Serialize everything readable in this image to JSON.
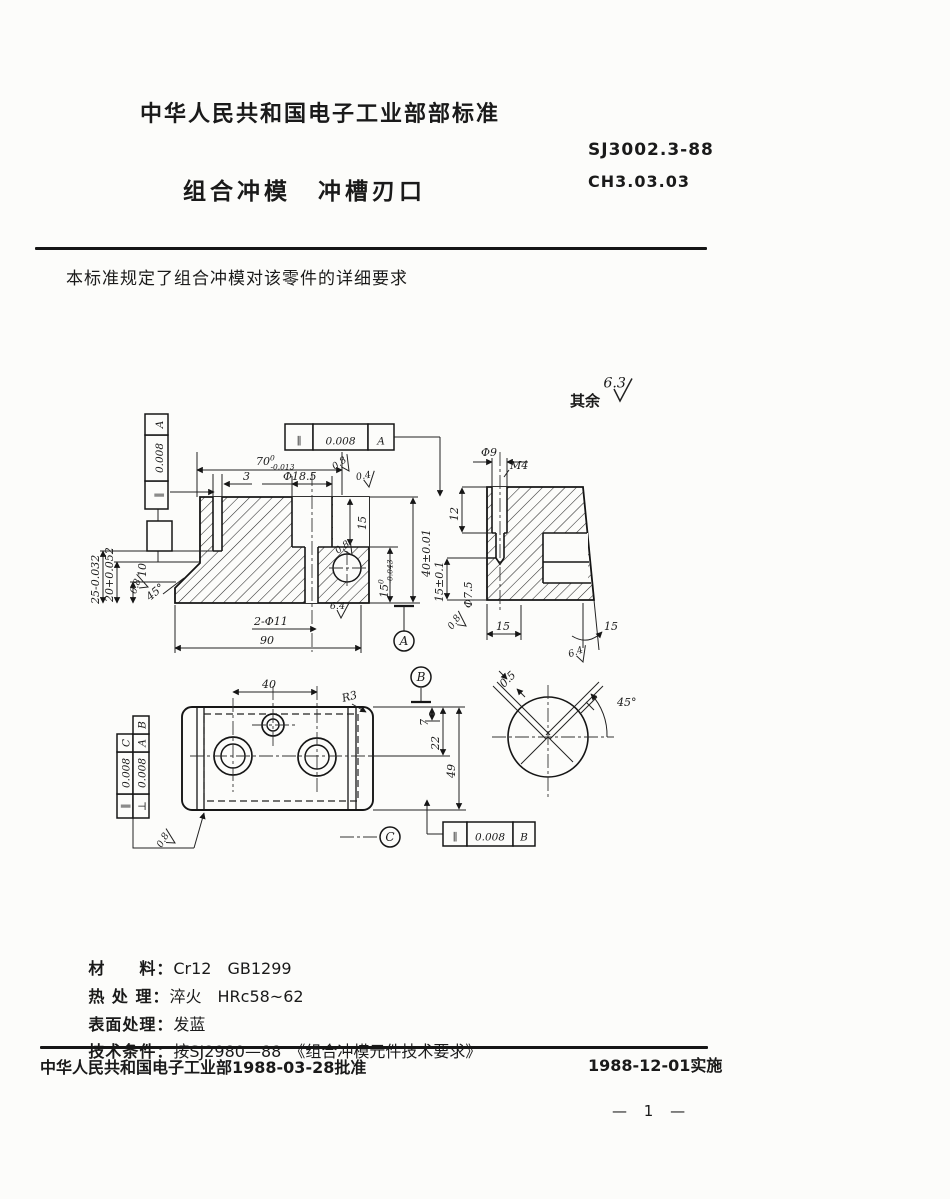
{
  "colors": {
    "ink": "#1a1a1a",
    "paper": "#fcfcfa"
  },
  "header": {
    "ministry_title": "中华人民共和国电子工业部部标准",
    "standard_no": "SJ3002.3-88",
    "code": "CH3.03.03",
    "part_title": "组合冲模　冲槽刃口"
  },
  "scope": "本标准规定了组合冲模对该零件的详细要求",
  "notes": [
    {
      "label": "材　　料：",
      "value": "Cr12　GB1299"
    },
    {
      "label": "热 处 理：",
      "value": "淬火　HRc58~62"
    },
    {
      "label": "表面处理：",
      "value": "发蓝"
    },
    {
      "label": "技术条件：",
      "value": "按SJ2980—88　《组合冲模元件技术要求》"
    }
  ],
  "footer": {
    "approval": "中华人民共和国电子工业部1988-03-28批准",
    "implementation": "1988-12-01实施",
    "page_no": "— 1 —"
  },
  "drawing": {
    "general_finish": {
      "prefix": "其余",
      "value": "6.3"
    },
    "labels": [
      {
        "t": "70",
        "sup": "0",
        "sub": "-0.013",
        "x": 256,
        "y": 465
      },
      {
        "t": "3",
        "x": 243,
        "y": 480
      },
      {
        "t": "Φ18.5",
        "x": 283,
        "y": 480
      },
      {
        "t": "15",
        "x": 366,
        "y": 530,
        "r": -90
      },
      {
        "t": "40±0.01",
        "x": 430,
        "y": 577,
        "r": -90
      },
      {
        "t": "15",
        "sup": "0",
        "sub": "-0.043",
        "x": 388,
        "y": 598,
        "r": -90
      },
      {
        "t": "2-Φ11",
        "x": 254,
        "y": 625
      },
      {
        "t": "90",
        "x": 260,
        "y": 644
      },
      {
        "t": "25-0.032",
        "x": 99,
        "y": 604,
        "r": -90
      },
      {
        "t": "20+0.052",
        "x": 113,
        "y": 602,
        "r": -90
      },
      {
        "t": "10",
        "x": 146,
        "y": 577,
        "r": -90
      },
      {
        "t": "45°",
        "x": 150,
        "y": 601,
        "r": -40
      },
      {
        "t": "Φ9",
        "x": 481,
        "y": 456
      },
      {
        "t": "M4",
        "x": 510,
        "y": 469
      },
      {
        "t": "12",
        "x": 458,
        "y": 521,
        "r": -90
      },
      {
        "t": "15±0.1",
        "x": 443,
        "y": 602,
        "r": -90
      },
      {
        "t": "Φ7.5",
        "x": 472,
        "y": 608,
        "r": -90
      },
      {
        "t": "15",
        "x": 496,
        "y": 630
      },
      {
        "t": "15",
        "x": 604,
        "y": 630
      },
      {
        "t": "40",
        "x": 262,
        "y": 688
      },
      {
        "t": "R3",
        "x": 343,
        "y": 702,
        "r": -15
      },
      {
        "t": "7",
        "x": 428,
        "y": 726,
        "r": -90
      },
      {
        "t": "22",
        "x": 439,
        "y": 750,
        "r": -90
      },
      {
        "t": "49",
        "x": 455,
        "y": 778,
        "r": -90
      },
      {
        "t": "0.5",
        "x": 504,
        "y": 688,
        "r": -45
      },
      {
        "t": "45°",
        "x": 617,
        "y": 706
      },
      {
        "t": "其余",
        "x": 570,
        "y": 406,
        "s": 15,
        "cjk": true
      }
    ],
    "frames": [
      {
        "x": 285,
        "y": 424,
        "h": 26,
        "cells": [
          {
            "t": "∥",
            "w": 28
          },
          {
            "t": "0.008",
            "w": 55
          },
          {
            "t": "A",
            "w": 26
          }
        ]
      },
      {
        "x": 145,
        "y": 509,
        "h": 23,
        "r": -90,
        "cells": [
          {
            "t": "∥",
            "w": 28
          },
          {
            "t": "0.008",
            "w": 46
          },
          {
            "t": "A",
            "w": 21
          }
        ]
      },
      {
        "x": 117,
        "y": 818,
        "h": 16,
        "r": -90,
        "cells": [
          {
            "t": "∥",
            "w": 24
          },
          {
            "t": "0.008",
            "w": 42
          },
          {
            "t": "C",
            "w": 18
          }
        ]
      },
      {
        "x": 133,
        "y": 818,
        "h": 16,
        "r": -90,
        "cells": [
          {
            "t": "⊥",
            "w": 24
          },
          {
            "t": "0.008",
            "w": 42
          },
          {
            "t": "A",
            "w": 18
          },
          {
            "t": "B",
            "w": 18
          }
        ]
      },
      {
        "x": 443,
        "y": 822,
        "h": 24,
        "cells": [
          {
            "t": "∥",
            "w": 24
          },
          {
            "t": "0.008",
            "w": 46
          },
          {
            "t": "B",
            "w": 22
          }
        ]
      }
    ],
    "datums": [
      {
        "t": "A",
        "x": 404,
        "y": 641
      },
      {
        "t": "B",
        "x": 421,
        "y": 677
      },
      {
        "t": "C",
        "x": 390,
        "y": 837
      }
    ],
    "finish_marks": [
      {
        "v": "6.3",
        "x": 620,
        "y": 401,
        "s": 1.5
      },
      {
        "v": "0.8",
        "x": 349,
        "y": 471,
        "r": -35
      },
      {
        "v": "0.4",
        "x": 369,
        "y": 487,
        "r": -10
      },
      {
        "v": "0.8",
        "x": 352,
        "y": 555,
        "r": -35
      },
      {
        "v": "6.4",
        "x": 341,
        "y": 618
      },
      {
        "v": "0.8",
        "x": 148,
        "y": 587,
        "r": -70
      },
      {
        "v": "0.8",
        "x": 466,
        "y": 626,
        "r": -55
      },
      {
        "v": "6.4",
        "x": 583,
        "y": 662,
        "r": -20
      },
      {
        "v": "0.8",
        "x": 175,
        "y": 843,
        "r": -60
      }
    ]
  }
}
